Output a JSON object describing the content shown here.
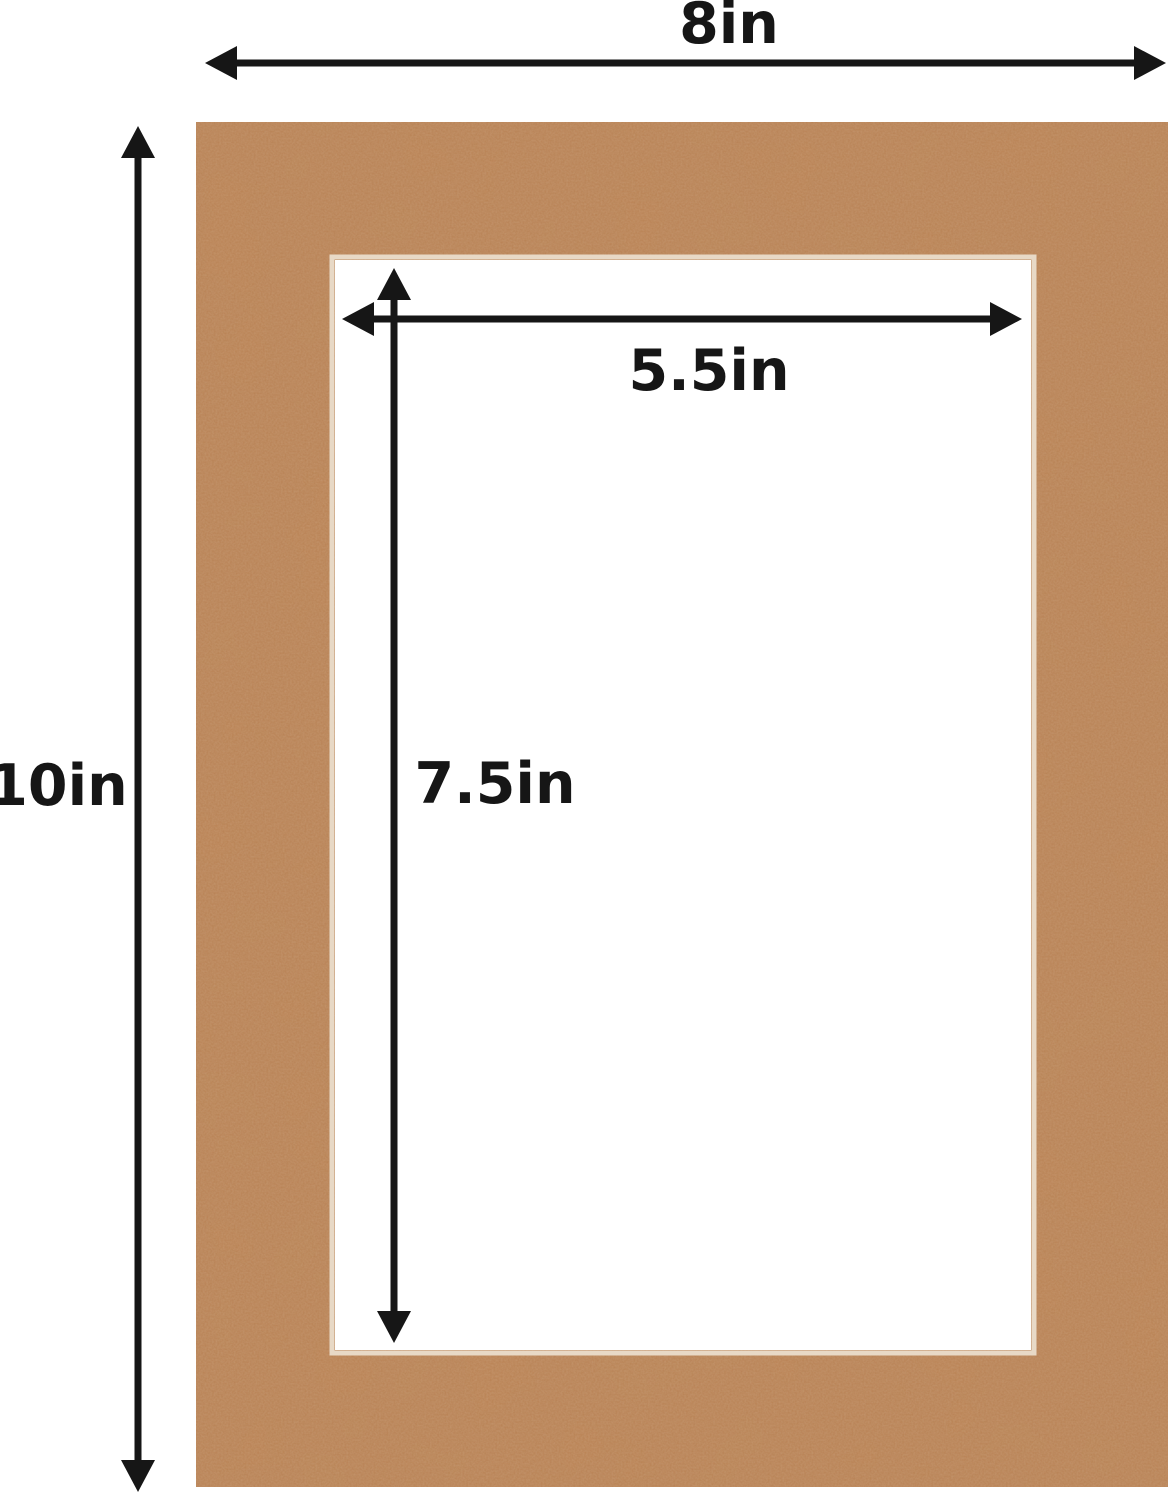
{
  "dimensions": {
    "outer_width_label": "8in",
    "outer_height_label": "10in",
    "opening_width_label": "5.5in",
    "opening_height_label": "7.5in"
  },
  "colors": {
    "mat": "#b97f50",
    "mat_edge": "#a86f42",
    "opening": "#ffffff",
    "arrows": "#161616",
    "text": "#161616",
    "background": "#ffffff"
  }
}
